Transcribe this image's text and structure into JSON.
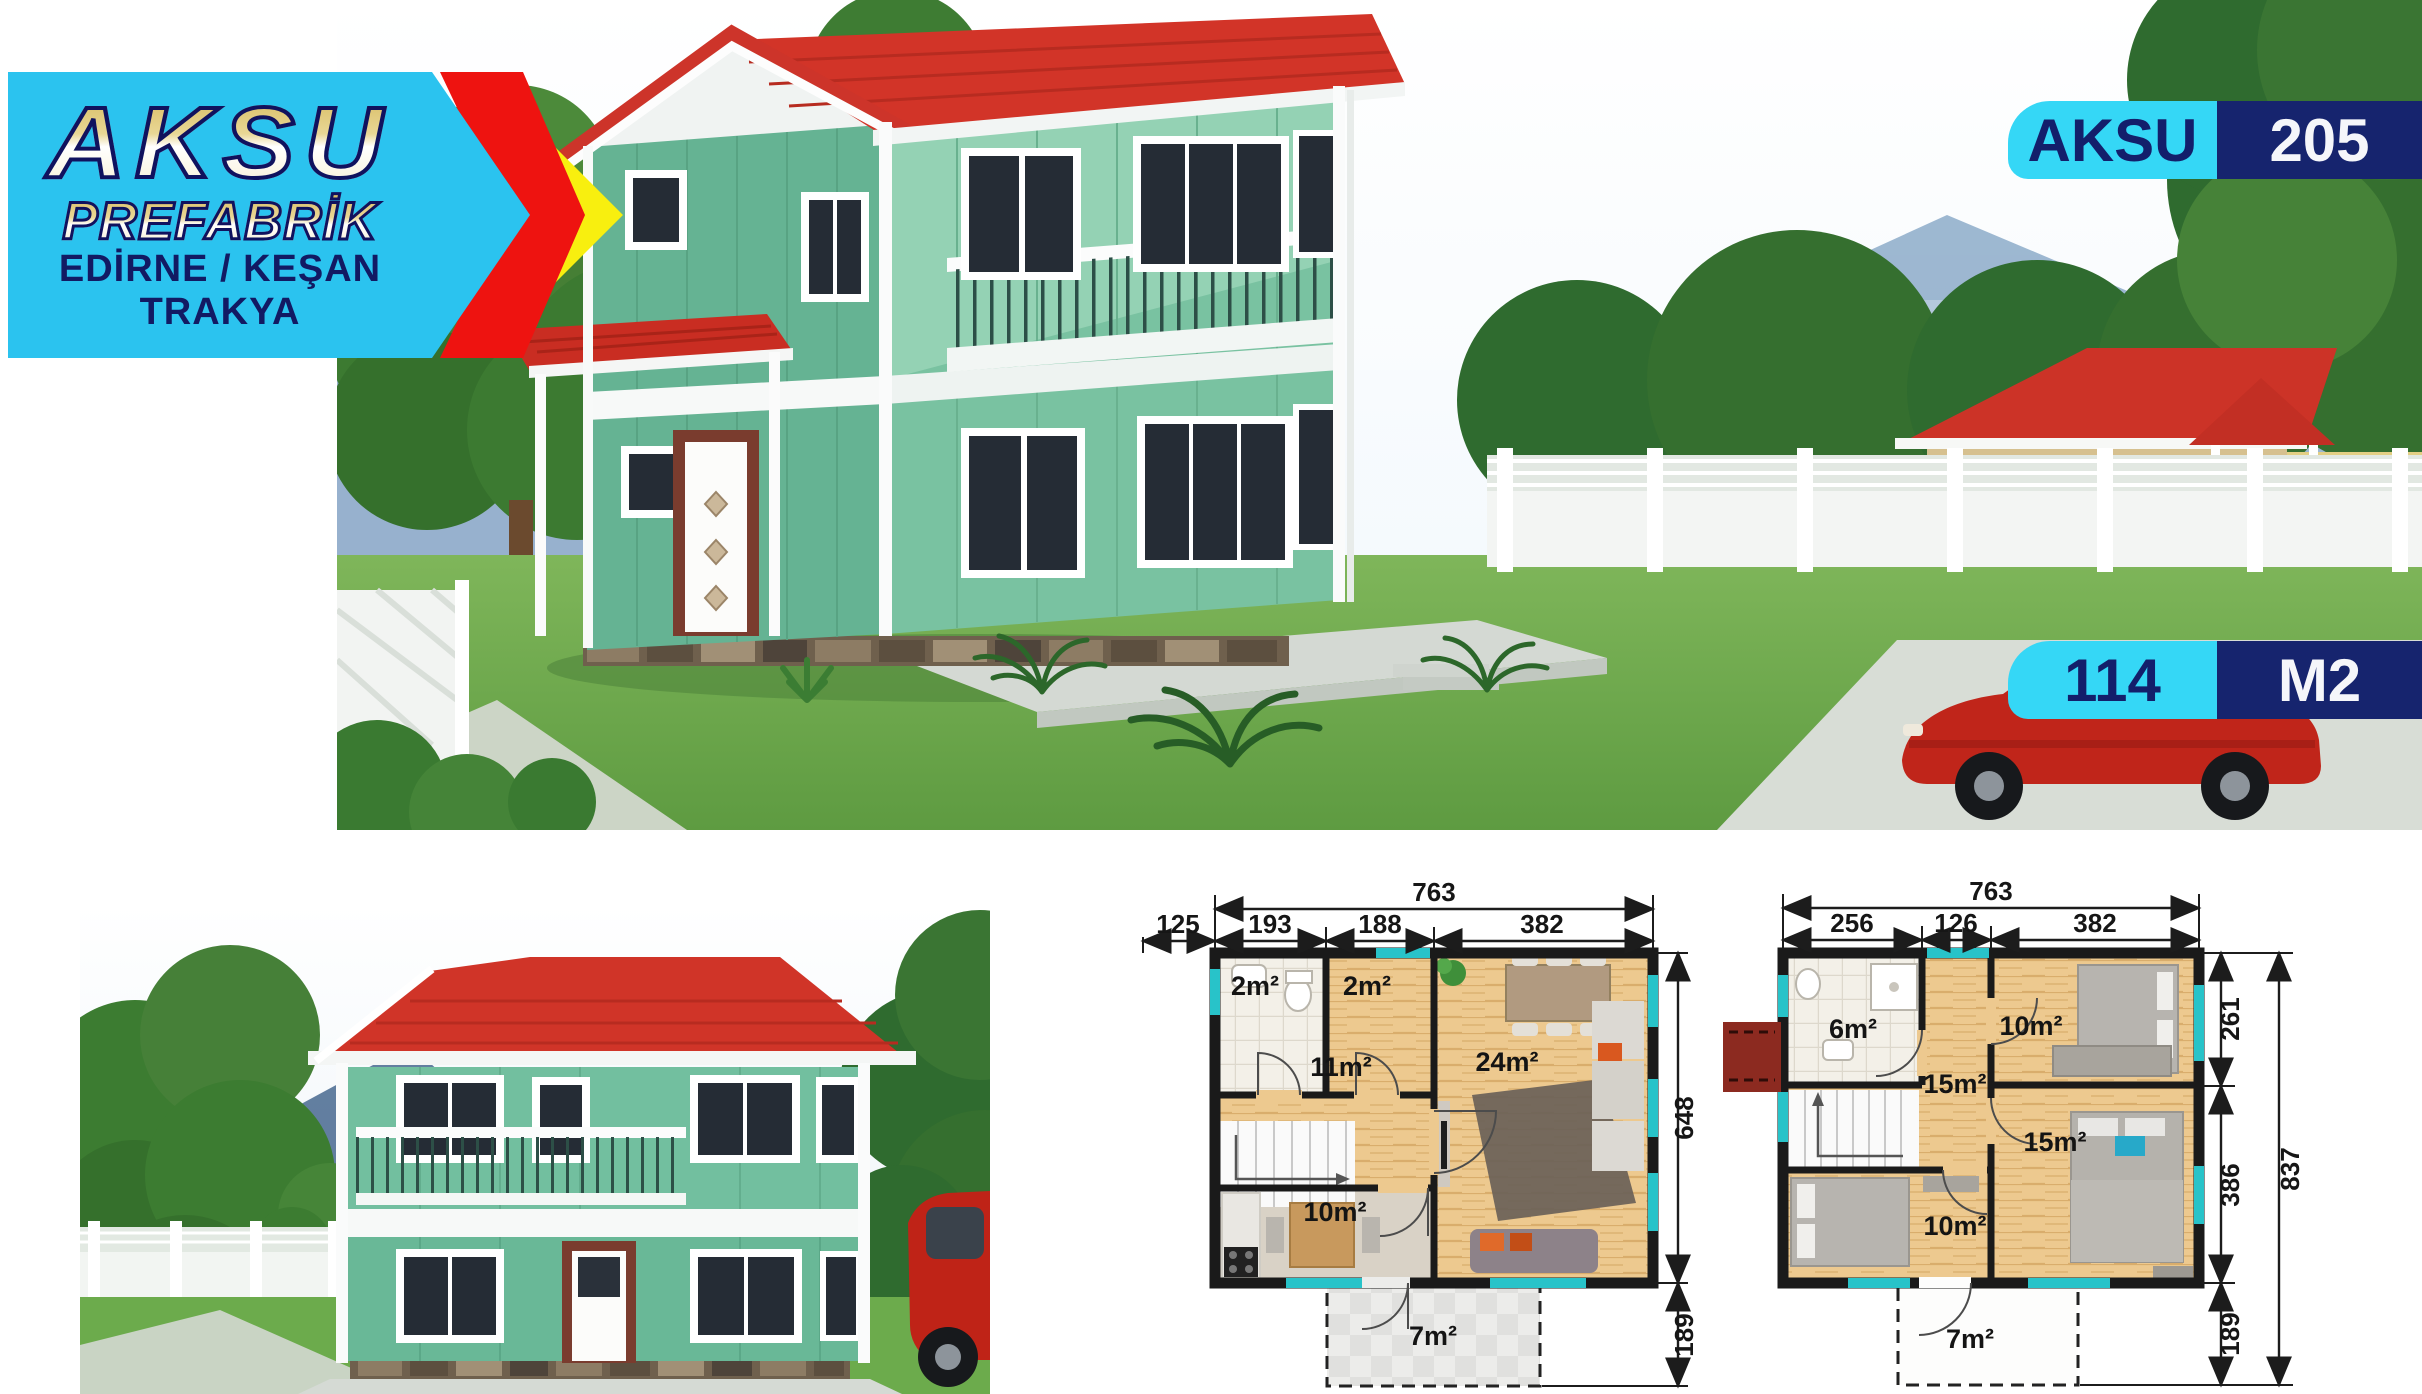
{
  "logo": {
    "brand": "AKSU",
    "subtitle": "PREFABRİK",
    "location_line1": "EDİRNE / KEŞAN",
    "location_line2": "TRAKYA",
    "colors": {
      "banner_cyan": "#2bc3ef",
      "arrow_red": "#ee1310",
      "arrow_yellow": "#f8ef0f",
      "navy": "#121a63"
    }
  },
  "model_badge": {
    "brand": "AKSU",
    "model": "205"
  },
  "area_badge": {
    "value": "114",
    "unit": "M2"
  },
  "colors": {
    "badge_cyan": "#35d7f6",
    "badge_navy": "#16246e",
    "roof_red": "#d23428",
    "wall_green": "#6fbfa0",
    "plan_window_cyan": "#28c3c9"
  },
  "plan_ground": {
    "dim_total_top": "763",
    "dims_top": [
      "125",
      "193",
      "188",
      "382"
    ],
    "dim_right_main": "648",
    "dim_right_terrace": "189",
    "room_bath": "2m²",
    "room_entry": "2m²",
    "room_hall": "11m²",
    "room_living": "24m²",
    "room_kitchen": "10m²",
    "room_terrace": "7m²"
  },
  "plan_upper": {
    "dim_total_top": "763",
    "dims_top": [
      "256",
      "126",
      "382"
    ],
    "dim_right_upper": "261",
    "dim_right_lower": "386",
    "dim_right_total": "837",
    "dim_right_terrace": "189",
    "room_bath": "6m²",
    "room_bedroom1": "10m²",
    "room_hall": "15m²",
    "room_bedroom2": "15m²",
    "room_bedroom3": "10m²",
    "room_terrace": "7m²"
  }
}
